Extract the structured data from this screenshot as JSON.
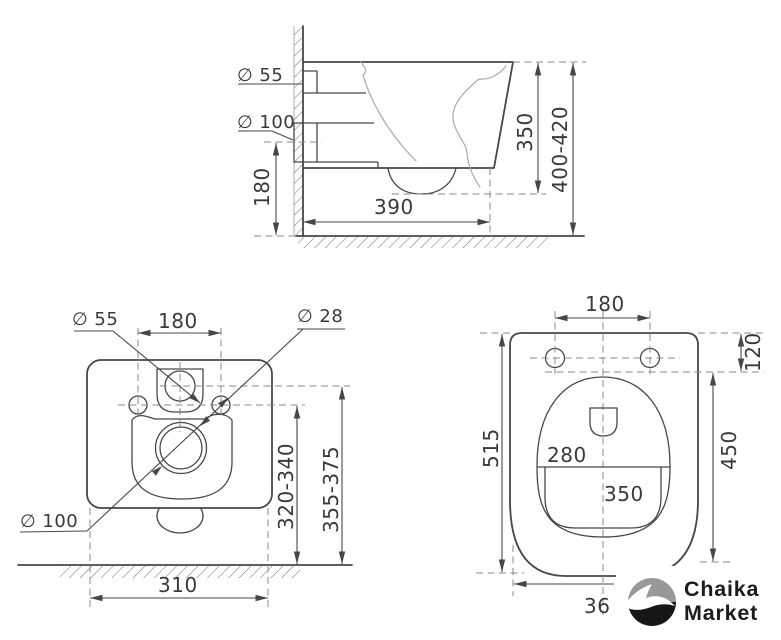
{
  "views": {
    "side": {
      "labels": {
        "inlet_d": "∅ 55",
        "outlet_d": "∅ 100",
        "outlet_height": "180",
        "depth": "390",
        "rim_height": "350",
        "total_height": "400-420"
      }
    },
    "rear": {
      "labels": {
        "inlet_d": "∅ 55",
        "bolt_spacing": "180",
        "bolt_d": "∅ 28",
        "outlet_d": "∅ 100",
        "bolt_height": "320-340",
        "inlet_height": "355-375",
        "width": "310"
      }
    },
    "plan": {
      "labels": {
        "bolt_spacing": "180",
        "bolt_offset": "120",
        "length": "515",
        "bowl_width": "280",
        "bowl_length": "350",
        "bowl_depth": "450",
        "width_partial": "36"
      }
    }
  },
  "logo": {
    "line1": "Chaika",
    "line2": "Market"
  },
  "colors": {
    "line": "#474747",
    "light_line": "#a9a9a9",
    "dashed": "#8a8a8a",
    "text": "#3a3a3a",
    "logo_gray": "#989898",
    "logo_black": "#161616",
    "background": "#ffffff"
  }
}
